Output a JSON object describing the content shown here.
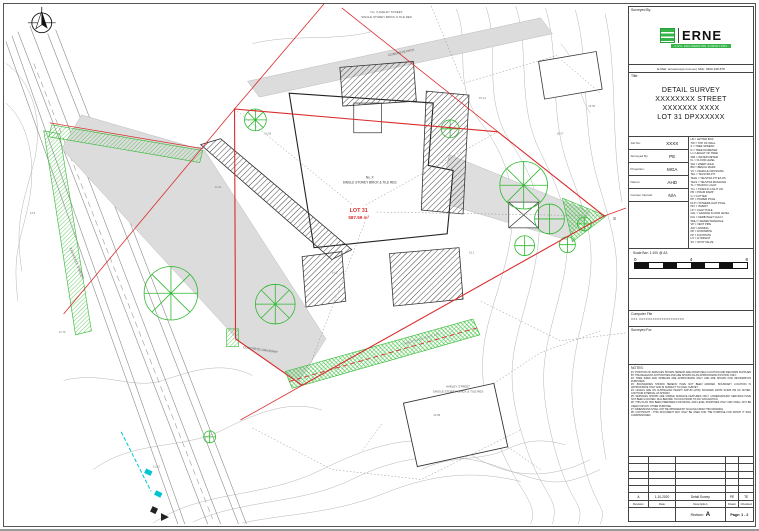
{
  "colors": {
    "accent_green": "#35b44a",
    "boundary_red": "#d92b2b",
    "vegetation_green": "#2db82d",
    "water_cyan": "#00c3d4"
  },
  "title_block": {
    "surveyed_by_label": "Surveyed By:",
    "logo": {
      "brand": "ERNE",
      "tagline": "CIVIL ENGINEERING SURVEYORS"
    },
    "contact": "E-Mail: ernesurveys.com.au  |  Mob: 0400 248 878",
    "title_label": "Title:",
    "title_lines": [
      "DETAIL SURVEY",
      "XXXXXXXX STREET",
      "XXXXXXX XXXX",
      "LOT 31 DPXXXXXX"
    ],
    "info_rows": [
      {
        "label": "Job No:",
        "value": "XXXX"
      },
      {
        "label": "Surveyed By:",
        "value": "PE"
      },
      {
        "label": "Projection:",
        "value": "MGA"
      },
      {
        "label": "Datum:",
        "value": "AHD"
      },
      {
        "label": "Contour Interval:",
        "value": "N/A"
      }
    ],
    "legend_items": [
      "LB = LETTER BOX",
      "TW = TOP OF WALL",
      "S = TREE SPREAD",
      "D = TREE DIAMETER",
      "H = HEIGHT OF TREE",
      "WM = WATER METER",
      "FL = FLOOR LEVEL",
      "WH = WEEP HOLE",
      "BM = BENCH MARK",
      "VX = VEHICLE CROSSING",
      "TEL = TELSTRA PIT",
      "TELE = TELSTRA PIT E/LOS",
      "TELS = TELSTRA MANHOLE",
      "TL = TRAFFIC LIGHT",
      "TLL = TRAFFIC LIGHT LID",
      "PR = PRAM RAMP",
      "G = GUTTER",
      "PP = POWER POLE",
      "PLP = POWER/LIGHT POLE",
      "INV = INVERT",
      "LP = LIGHT POLE",
      "GFL = GARAGE FLOOR LEVEL",
      "KIG = KERB INLET GULLY",
      "SMH = SEWER MANHOLE",
      "VP = VENT PIPE",
      "AW = AWNING",
      "DP = DOWNPIPE",
      "FP = FOOTPATH",
      "HY = HYDRANT",
      "SV = STOP VALVE"
    ],
    "scale_bar": {
      "label": "Scale Bar: 1:100 @ A3",
      "ticks": [
        "0",
        "4",
        "8"
      ]
    },
    "computer_file_label": "Computer File",
    "computer_file_value": "XXX XXXXXXXXXXXXXXXXXXXX",
    "surveyed_for_label": "Surveyed For:",
    "notes_label": "NOTES:",
    "notes": [
      "#1: POSITION OF SERVICES SHOWN HEREON ARE FROM FIELD LOCATION AND RECORDS SUPPLIED BY THE RELEVANT AUTHORITIES AND ARE SHOWN AS AN APPROXIMATE POSITION ONLY.",
      "#2: TREE SIZES AND SPREADS ARE APPROXIMATE ONLY AND ARE SHOWN FOR INFORMATION PURPOSES.",
      "#3: BOUNDARIES SHOWN HEREON HAVE NOT BEEN MARKED. BOUNDARY LOCATION IS APPROXIMATE ONLY AND IS SUBJECT TO FINAL SURVEY.",
      "#4: LEVELS ARE ON AUSTRALIAN HEIGHT DATUM (AHD) SOURCED FROM SCIMS PM AS NOTED. CONTOUR INTERVAL AS SHOWN.",
      "#5: SERVICES SHOWN ARE VISIBLE SURFACE FEATURES ONLY. UNDERGROUND SERVICES HAVE NOT BEEN LOCATED. DIAL BEFORE YOU DIG PRIOR TO ANY EXCAVATION.",
      "#6: THIS PLAN HAS BEEN PREPARED FOR DETAIL AND LEVEL PURPOSES ONLY AND SHALL NOT BE USED FOR ANY OTHER PURPOSE.",
      "#7: DIMENSIONS SHALL NOT BE OBTAINED BY SCALING FROM THIS DRAWING.",
      "#8: COPYRIGHT - THIS DOCUMENT MAY ONLY BE USED FOR THE PURPOSE FOR WHICH IT WAS COMMISSIONED."
    ],
    "revision_table": {
      "headers": [
        "Revision",
        "Date",
        "Description",
        "Drawn",
        "Checked"
      ],
      "rows": [
        {
          "revision": "A",
          "date": "1-10-2020",
          "description": "Detail Survey",
          "drawn": "PE",
          "checked": "TE"
        }
      ],
      "revision_label": "Revision:",
      "current_revision": "A",
      "page_label": "Page: 1 - 2"
    }
  },
  "drawing": {
    "lot_name": "LOT 31",
    "lot_area": "587.59 m²",
    "building_no": "No. X",
    "building_desc": "SINGLE STOREY BRICK & TILE RES",
    "top_neighbour_line1": "No. X AVELEY STREET",
    "top_neighbour_line2": "SINGLE STOREY BRICK & TILE RES",
    "bottom_neighbour_line1": "AVELEY STREET",
    "bottom_neighbour_line2": "SINGLE STOREY BRICK & TILE RES",
    "driveway_label": "CONCRETE DRIVEWAY",
    "path_label": "CONCRETE PATH",
    "fence_label": "TIMBER PALING FENCE 1.8H",
    "street_label": "XXXXXXXX STREET",
    "corner_mark": "S",
    "spots": [
      "14.38",
      "14.21",
      "13.96",
      "15.12",
      "16.07",
      "12.75",
      "11.82",
      "16.55",
      "10.98",
      "13.9",
      "14.6",
      "15.1"
    ]
  }
}
